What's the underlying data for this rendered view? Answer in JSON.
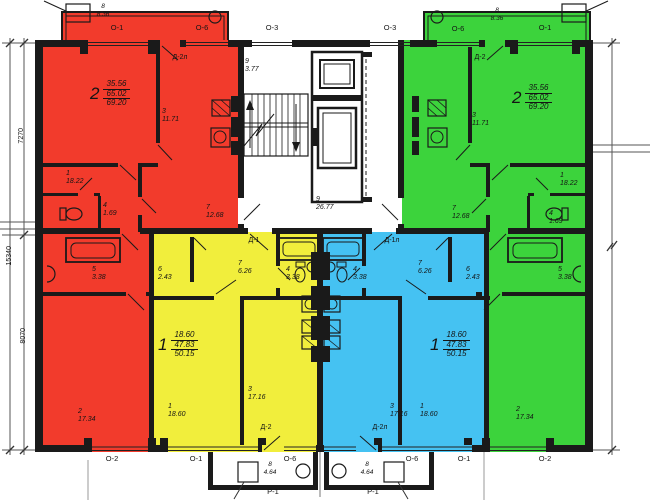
{
  "colors": {
    "red": "#f23b2c",
    "green": "#3cd33c",
    "yellow": "#f1ee3c",
    "blue": "#45c2f2",
    "ink": "#1a1a1a"
  },
  "apartments": {
    "red": {
      "number": "2",
      "area_top": "35.56",
      "area_mid": "65.02",
      "area_total": "69.20",
      "balcony_door": "Д-2л",
      "rooms": {
        "r3": {
          "num": "3",
          "area": "11.71"
        },
        "r1": {
          "num": "1",
          "area": "18.22"
        },
        "r4": {
          "num": "4",
          "area": "1.69"
        },
        "r7": {
          "num": "7",
          "area": "12.68"
        },
        "r5": {
          "num": "5",
          "area": "3.38"
        },
        "r2": {
          "num": "2",
          "area": "17.34"
        }
      }
    },
    "green": {
      "number": "2",
      "area_top": "35.56",
      "area_mid": "65.02",
      "area_total": "69.20",
      "balcony_door": "Д-2",
      "rooms": {
        "r3": {
          "num": "3",
          "area": "11.71"
        },
        "r1": {
          "num": "1",
          "area": "18.22"
        },
        "r4": {
          "num": "4",
          "area": "1.69"
        },
        "r7": {
          "num": "7",
          "area": "12.68"
        },
        "r5": {
          "num": "5",
          "area": "3.38"
        },
        "r2": {
          "num": "2",
          "area": "17.34"
        }
      }
    },
    "yellow": {
      "number": "1",
      "area_top": "18.60",
      "area_mid": "47.83",
      "area_total": "50.15",
      "entry_door": "Д-1",
      "balcony_door": "Д-2",
      "rooms": {
        "r6": {
          "num": "6",
          "area": "2.43"
        },
        "r7": {
          "num": "7",
          "area": "6.26"
        },
        "r4": {
          "num": "4",
          "area": "3.38"
        },
        "r1": {
          "num": "1",
          "area": "18.60"
        },
        "r3": {
          "num": "3",
          "area": "17.16"
        }
      }
    },
    "blue": {
      "number": "1",
      "area_top": "18.60",
      "area_mid": "47.83",
      "area_total": "50.15",
      "entry_door": "Д-1л",
      "balcony_door": "Д-2л",
      "rooms": {
        "r6": {
          "num": "6",
          "area": "2.43"
        },
        "r7": {
          "num": "7",
          "area": "6.26"
        },
        "r4": {
          "num": "4",
          "area": "3.38"
        },
        "r1": {
          "num": "1",
          "area": "18.60"
        },
        "r3": {
          "num": "3",
          "area": "17.16"
        }
      }
    }
  },
  "core": {
    "stair": {
      "num": "9",
      "area": "3.77"
    },
    "hall": {
      "num": "9",
      "area": "26.77"
    }
  },
  "balconies": {
    "top_left": {
      "num": "8",
      "area": "8.36"
    },
    "top_right": {
      "num": "8",
      "area": "8.36"
    },
    "bottom_left": {
      "num": "8",
      "area": "4.64"
    },
    "bottom_right": {
      "num": "8",
      "area": "4.64"
    }
  },
  "windows": {
    "o1": "О-1",
    "o2": "О-2",
    "o3": "О-3",
    "o6": "О-6"
  },
  "panel": "Р-1",
  "dimensions": {
    "total": "15340",
    "upper": "7270",
    "lower": "8070"
  }
}
